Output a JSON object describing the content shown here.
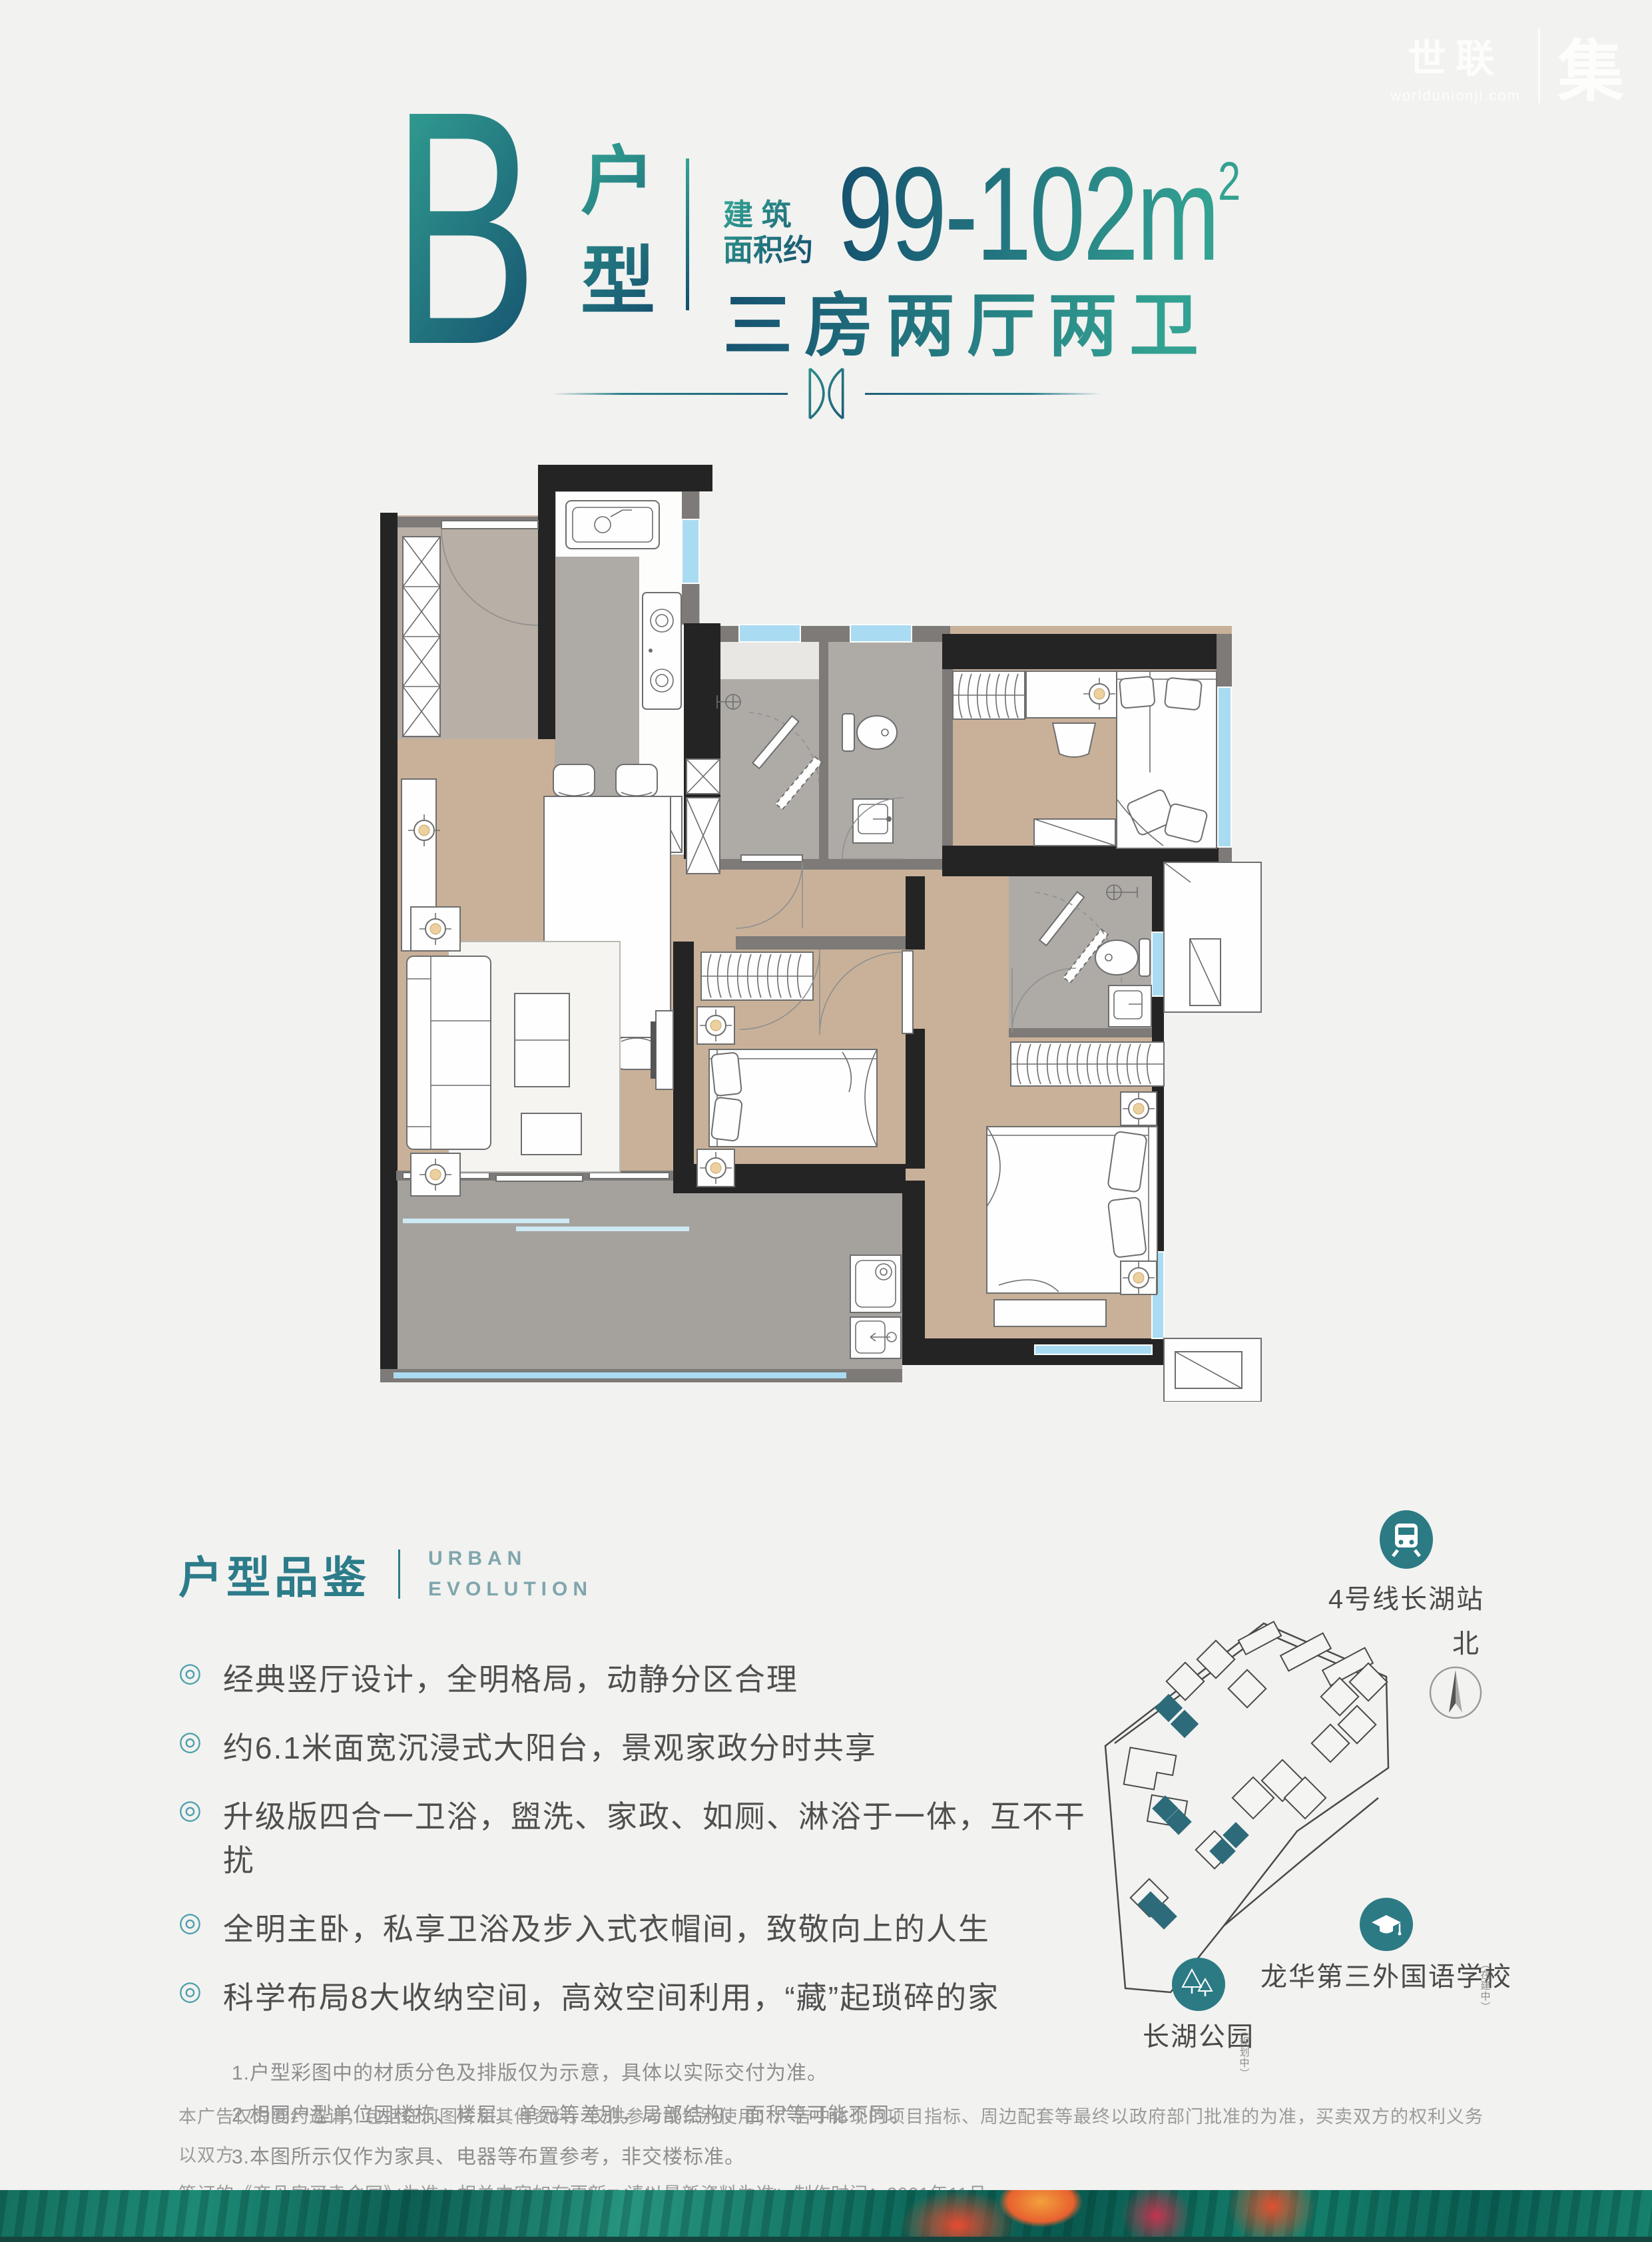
{
  "theme": {
    "bg": "#f2f2f0",
    "accent_from": "#33a292",
    "accent_to": "#15506f",
    "teal": "#2c7c8a",
    "teal_soft": "#7fa6ad",
    "icon_teal": "#4d9fac",
    "text": "#4f4f4f",
    "note": "#8e8e8e",
    "footer": "#9b9b9b",
    "wall": "#242424",
    "wall2": "#7d7a77",
    "wood": "#c9b199",
    "tile_entry": "#b8afa6",
    "tile": "#aeaba7",
    "tile_balcony": "#a5a29e",
    "win": "#a9dcf2",
    "gold": "#ecd0a0",
    "line": "#6e6e6e",
    "map_line": "#4a4a4a",
    "map_teal": "#2d6b7a",
    "map_icon": "#2b7a84",
    "map_text": "#4a4a4a"
  },
  "watermark": {
    "cn": "世联",
    "domain": "worldunionji.com",
    "right": "集"
  },
  "header": {
    "unit_letter": "B",
    "unit_label": "户型",
    "area_prefix_line1": "建 筑",
    "area_prefix_line2": "面积约",
    "area_value": "99-102m",
    "area_sup": "2",
    "layout_desc": "三房两厅两卫"
  },
  "appraisal": {
    "title": "户型品鉴",
    "en_line1": "URBAN",
    "en_line2": "EVOLUTION",
    "bullet_icon": "◎",
    "bullets": [
      "经典竖厅设计，全明格局，动静分区合理",
      "约6.1米面宽沉浸式大阳台，景观家政分时共享",
      "升级版四合一卫浴，盥洗、家政、如厕、淋浴于一体，互不干扰",
      "全明主卧，私享卫浴及步入式衣帽间，致敬向上的人生",
      "科学布局8大收纳空间，高效空间利用，“藏”起琐碎的家"
    ],
    "notes": [
      "1.户型彩图中的材质分色及排版仅为示意，具体以实际交付为准。",
      "2.相同户型单位因楼栋、楼层、单元等差别，局部结构、面积等可能不同。",
      "3.本图所示仅作为家具、电器等布置参考，非交楼标准。",
      "4.本户型图仅为装修示意图，展示户内空间结构，非交付标准。"
    ]
  },
  "site_map": {
    "metro_label": "4号线长湖站",
    "north_label": "北",
    "school_label": "龙华第三外国语学校",
    "school_note": "（在建中）",
    "park_label": "长湖公园",
    "park_note": "（规划中）"
  },
  "footer": {
    "line1": "本广告仅为要约邀请，包括任何图片和其他资料，仅供参考或识别使用；广告中体现的项目指标、周边配套等最终以政府部门批准的为准，买卖双方的权利义务以双方",
    "line2": "签订的《商品房买卖合同》为准。相关内容如有更新，请以最新资料为准。制作时间：2021年11月"
  }
}
